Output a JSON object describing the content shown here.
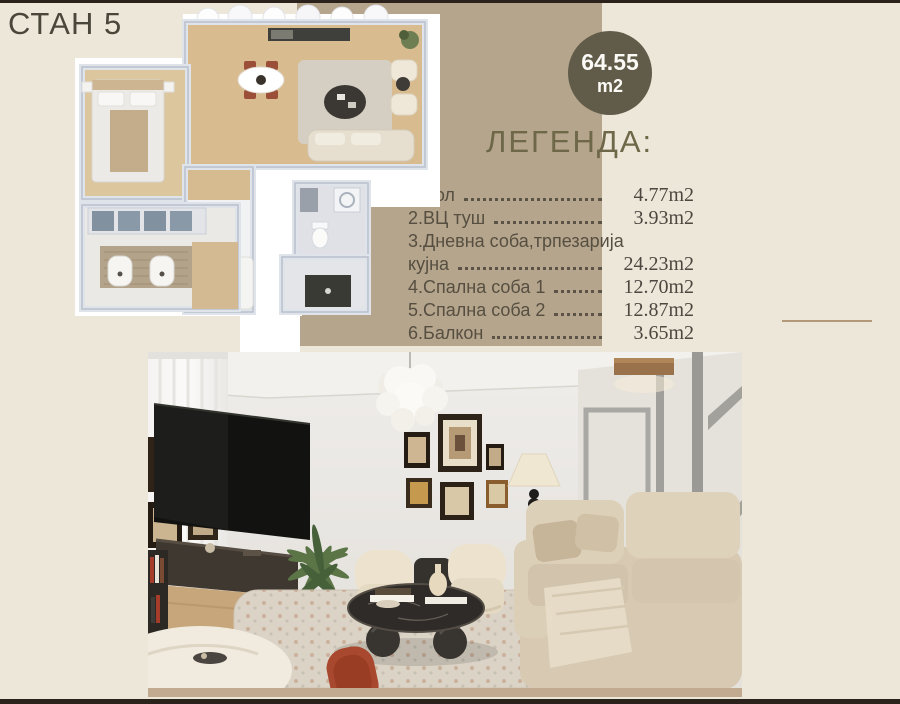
{
  "title": "СТАН 5",
  "badge": {
    "area": "64.55",
    "unit": "m2"
  },
  "legend": {
    "heading": "ЛЕГЕНДА:",
    "rows": [
      {
        "label": "1.Хол",
        "value": "4.77m2",
        "leader": true
      },
      {
        "label": "2.ВЦ туш",
        "value": "3.93m2",
        "leader": true
      },
      {
        "label": "3.Дневна соба,трпезарија",
        "value": "",
        "leader": false
      },
      {
        "label": "кујна",
        "value": "24.23m2",
        "leader": true
      },
      {
        "label": "4.Спална соба 1",
        "value": "12.70m2",
        "leader": true
      },
      {
        "label": "5.Спална соба 2",
        "value": "12.87m2",
        "leader": true
      },
      {
        "label": "6.Балкон",
        "value": "3.65m2",
        "leader": true
      }
    ]
  },
  "figures": {
    "floor_plan_alt": "apartment-top-view-floor-plan",
    "photo_alt": "living-room-interior-render"
  },
  "colors": {
    "page_bg": "#EDE7DA",
    "tan_band": "#B5A58C",
    "badge_bg": "#615C49",
    "heading": "#6E6748",
    "text": "#564F41",
    "dark_bar": "#2B221C"
  }
}
